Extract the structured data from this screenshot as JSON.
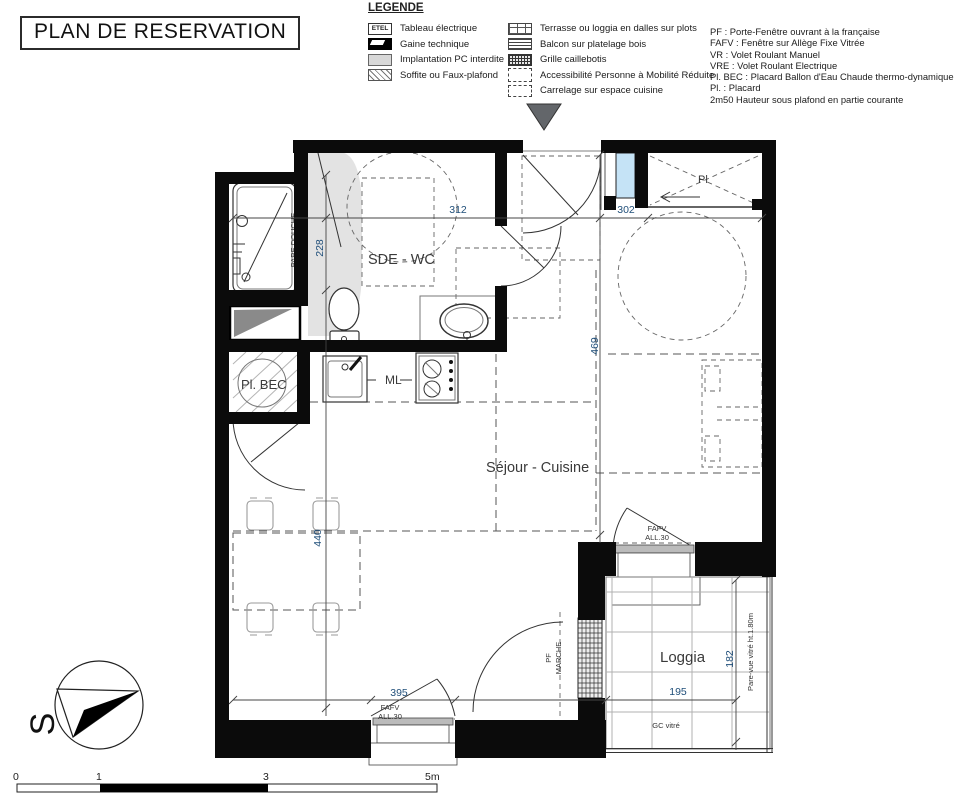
{
  "title": "PLAN DE RESERVATION",
  "legend": {
    "heading": "LEGENDE",
    "col1": [
      {
        "swatch": "etel",
        "swatch_text": "ETEL",
        "label": "Tableau électrique"
      },
      {
        "swatch": "gaine",
        "label": "Gaine technique"
      },
      {
        "swatch": "pc",
        "label": "Implantation PC interdite"
      },
      {
        "swatch": "soffite",
        "label": "Soffite ou Faux-plafond"
      }
    ],
    "col2": [
      {
        "swatch": "terrasse",
        "label": "Terrasse ou loggia en dalles sur plots"
      },
      {
        "swatch": "balcon",
        "label": "Balcon sur platelage bois"
      },
      {
        "swatch": "grille",
        "label": "Grille caillebotis"
      },
      {
        "swatch": "pmr",
        "label": "Accessibilité Personne à Mobilité Réduite"
      },
      {
        "swatch": "carrelage",
        "label": "Carrelage sur espace cuisine"
      }
    ]
  },
  "abbreviations": [
    "PF : Porte-Fenêtre ouvrant à la française",
    "FAFV : Fenêtre sur Allège Fixe Vitrée",
    "VR : Volet Roulant Manuel",
    "VRE : Volet Roulant Electrique",
    "Pl. BEC : Placard Ballon d'Eau Chaude thermo-dynamique",
    "Pl. : Placard",
    "2m50 Hauteur sous plafond en partie courante"
  ],
  "plan": {
    "rooms": {
      "sde_wc": "SDE - WC",
      "sejour": "Séjour - Cuisine",
      "loggia": "Loggia",
      "pl_bec": "Pl. BEC",
      "pl": "Pl",
      "ml": "ML"
    },
    "annotations": {
      "pare_douche": "PARE DOUCHE",
      "pf": "PF",
      "marche": "MARCHE",
      "fafv": "FAFV",
      "all30": "ALL.30",
      "gc_vitre": "GC vitré",
      "pare_vue": "Pare-vue vitré ht.1.80m"
    },
    "dims": {
      "d312": "312",
      "d228": "228",
      "d302": "302",
      "d469": "469",
      "d440": "440",
      "d395": "395",
      "d195": "195",
      "d182": "182"
    }
  },
  "compass": {
    "south": "S"
  },
  "scale_bar": {
    "t0": "0",
    "t1": "1",
    "t3": "3",
    "t5": "5m"
  },
  "colors": {
    "wall": "#0b0b0b",
    "dimension_text": "#1f4e79",
    "glazing_blue": "#c5e3f6",
    "restricted_zone_gray": "#e3e3e3",
    "entry_marker_gray": "#63666a"
  }
}
